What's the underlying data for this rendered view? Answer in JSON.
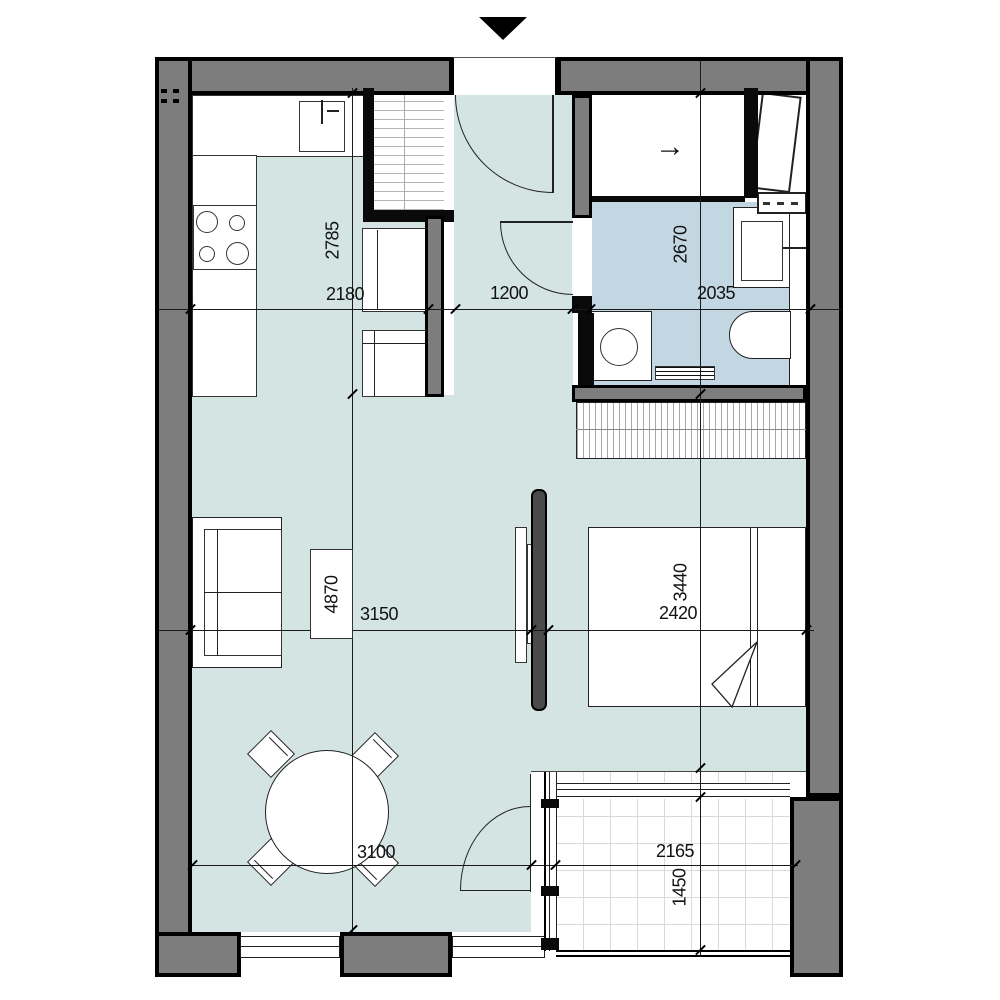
{
  "dimensions": {
    "kitchen_depth": "2785",
    "kitchen_width": "2180",
    "hall_width": "1200",
    "bathroom_depth": "2670",
    "bathroom_width": "2035",
    "living_depth": "4870",
    "living_width": "3150",
    "bedroom_depth": "3440",
    "bedroom_width": "2420",
    "dining_width": "3100",
    "balcony_width": "2165",
    "balcony_depth": "1450"
  },
  "icons": {
    "entry_arrow": "▼",
    "sliding_door_arrow": "→"
  },
  "colors": {
    "wall_fill": "#7d7d7d",
    "wall_outline": "#000000",
    "floor_main": "#d3e4e2",
    "floor_bathroom": "#c3d7e2",
    "partition_fill": "#4a4a4a",
    "balcony_grid": "#d9d9d9"
  }
}
